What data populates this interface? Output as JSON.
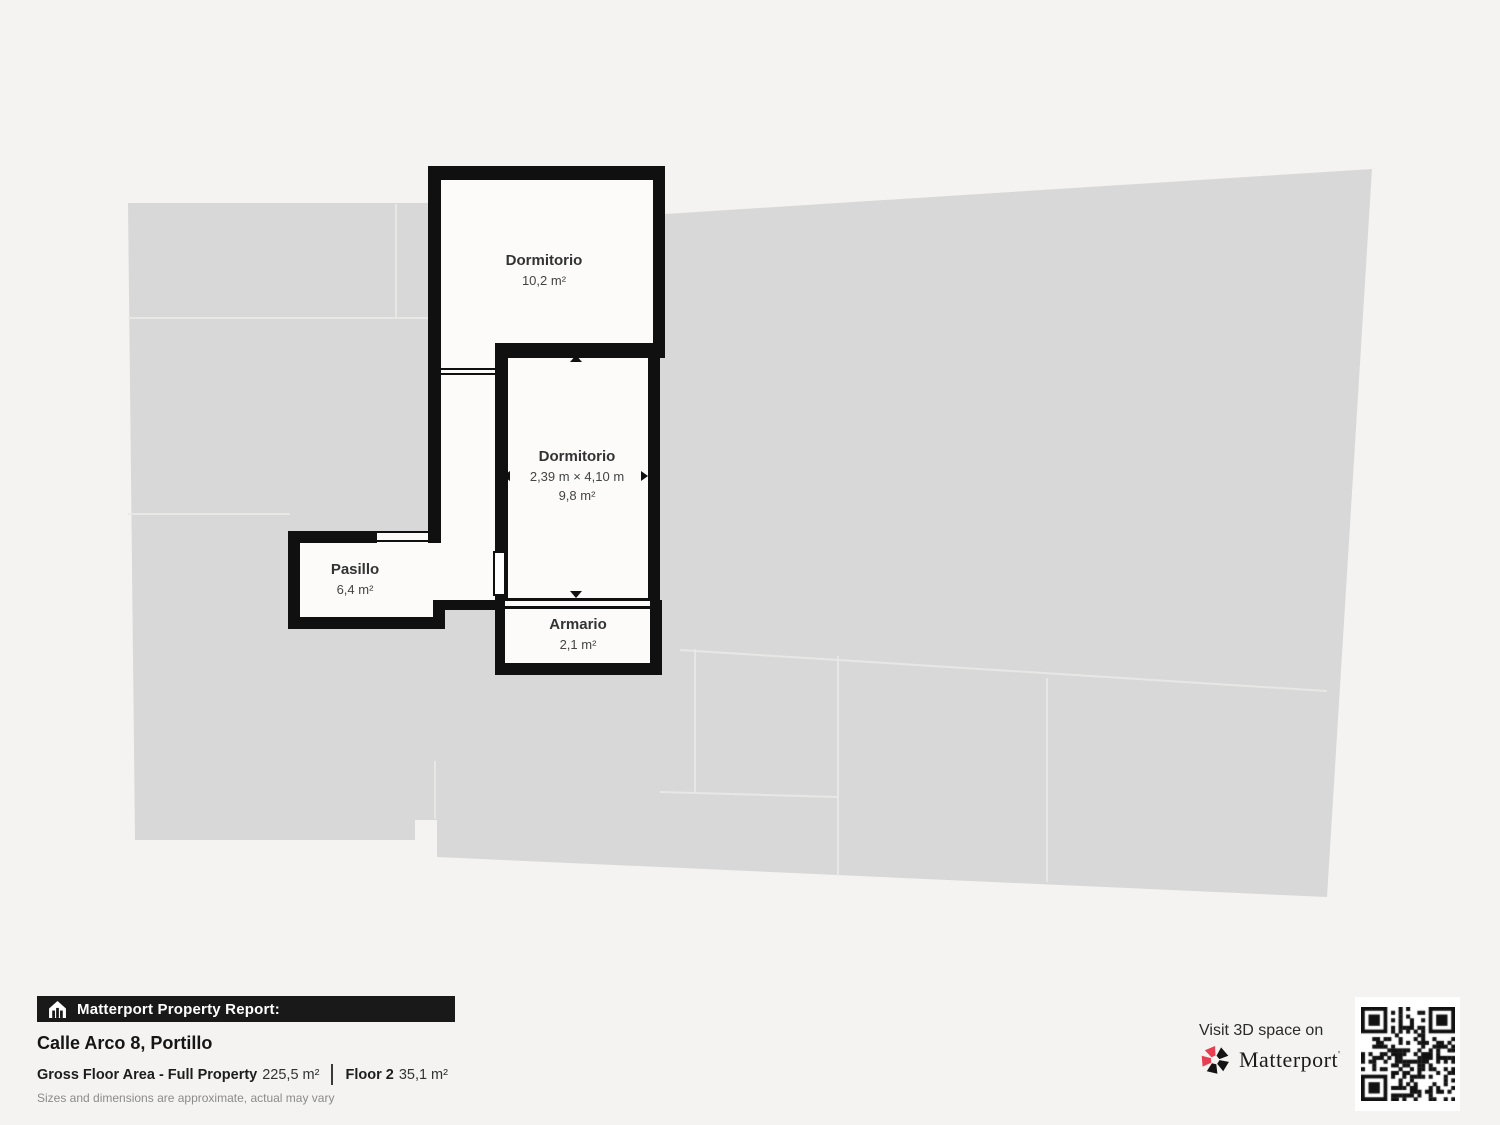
{
  "floorplan": {
    "rooms": [
      {
        "id": "dormitorio-1",
        "name": "Dormitorio",
        "area": "10,2 m²"
      },
      {
        "id": "dormitorio-2",
        "name": "Dormitorio",
        "dimensions": "2,39 m × 4,10 m",
        "area": "9,8 m²"
      },
      {
        "id": "pasillo",
        "name": "Pasillo",
        "area": "6,4 m²"
      },
      {
        "id": "armario",
        "name": "Armario",
        "area": "2,1 m²"
      }
    ]
  },
  "report": {
    "banner_label": "Matterport Property Report:",
    "address": "Calle Arco 8, Portillo",
    "gross_label": "Gross Floor Area - Full Property",
    "gross_value": "225,5 m²",
    "floor_label": "Floor 2",
    "floor_value": "35,1 m²",
    "disclaimer": "Sizes and dimensions are approximate, actual may vary"
  },
  "cta": {
    "visit_label": "Visit 3D space on",
    "brand": "Matterport"
  },
  "colors": {
    "background": "#f4f3f1",
    "footprint": "#d8d8d8",
    "wall": "#101010",
    "room_fill": "#fcfbfa",
    "banner_bg": "#191919",
    "brand_red": "#e73e51"
  }
}
